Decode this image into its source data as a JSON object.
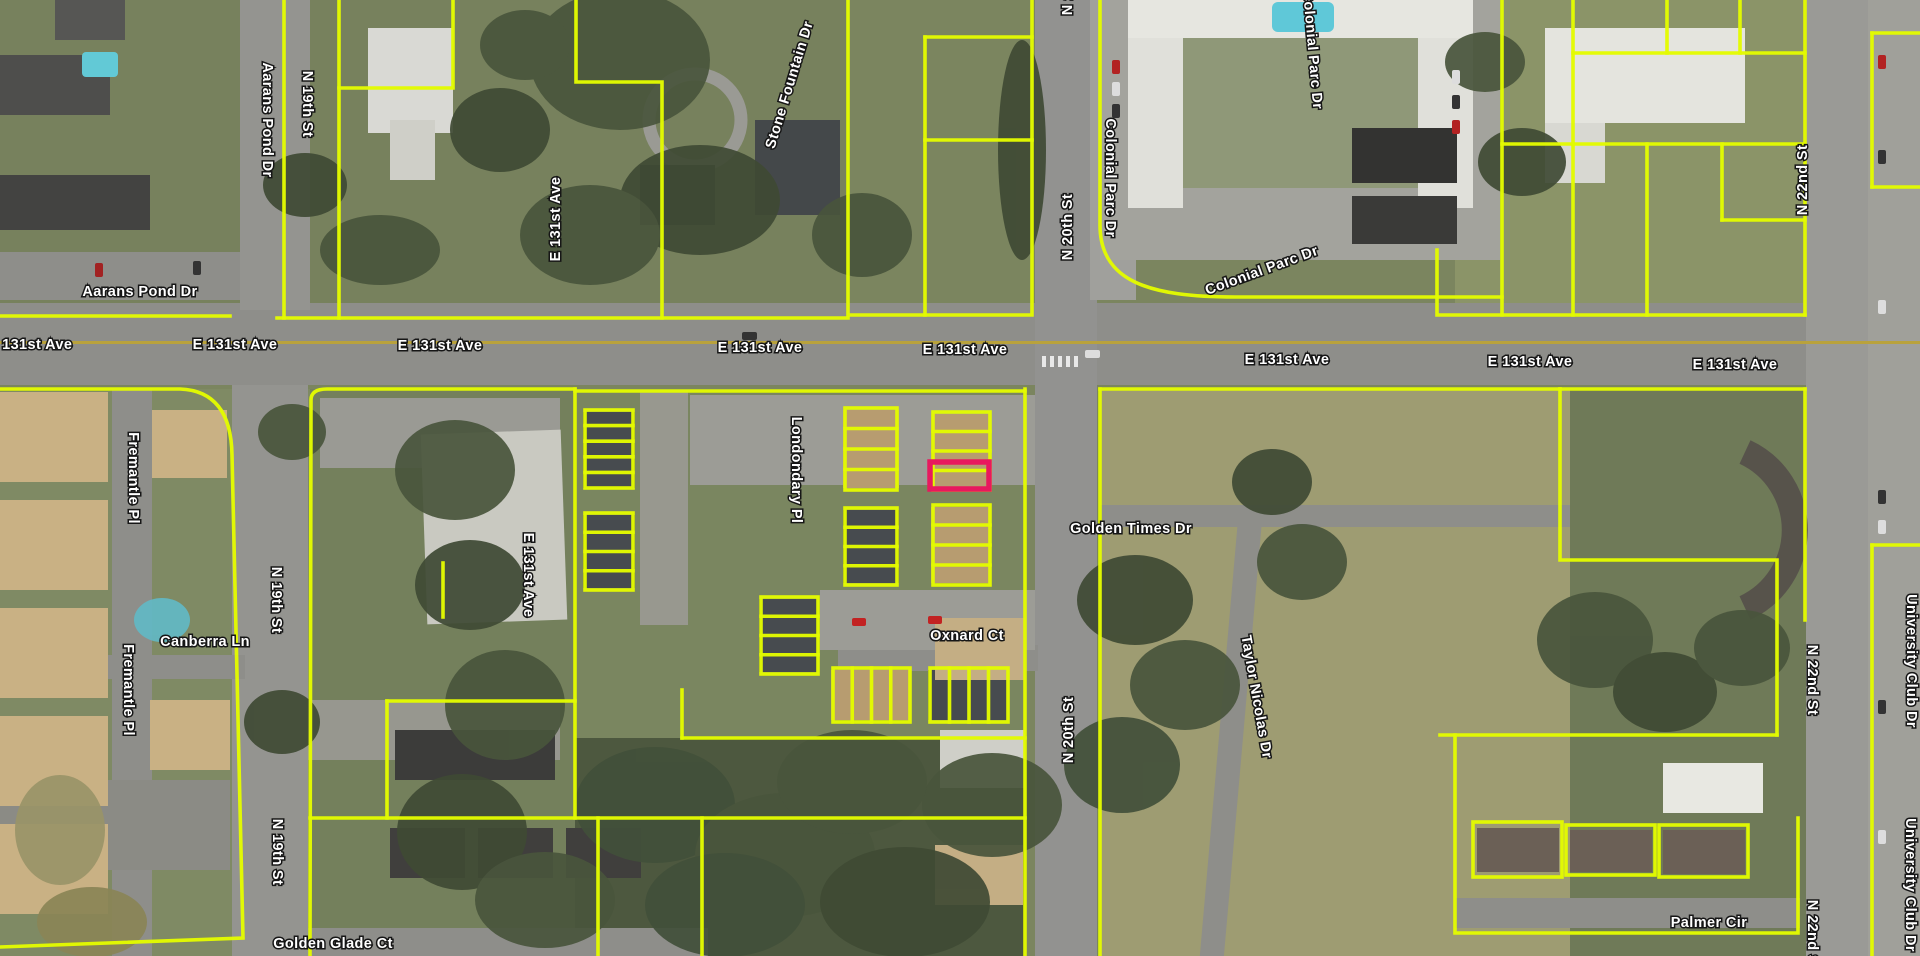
{
  "map": {
    "view_type": "aerial-parcel-map",
    "colors": {
      "parcel_outline": "#e3fb00",
      "selected_parcel": "#e8185e",
      "label_fill": "#ffffff",
      "label_halo": "#161616",
      "road": "#8e8e8a",
      "centerline": "#b9a23c"
    },
    "selected_parcel": {
      "x": 930,
      "y": 462,
      "width": 59,
      "height": 27
    },
    "street_labels": [
      {
        "text": "Aarans Pond Dr",
        "x": 267,
        "y": 120,
        "rot": 90
      },
      {
        "text": "N 19th St",
        "x": 307,
        "y": 104,
        "rot": 90
      },
      {
        "text": "Aarans Pond Dr",
        "x": 140,
        "y": 292,
        "rot": 0
      },
      {
        "text": "E 131st Ave",
        "x": 30,
        "y": 345,
        "rot": 0
      },
      {
        "text": "E 131st Ave",
        "x": 235,
        "y": 345,
        "rot": 0
      },
      {
        "text": "E 131st Ave",
        "x": 440,
        "y": 346,
        "rot": 0
      },
      {
        "text": "E 131st Ave",
        "x": 760,
        "y": 348,
        "rot": 0
      },
      {
        "text": "E 131st Ave",
        "x": 965,
        "y": 350,
        "rot": 0
      },
      {
        "text": "E 131st Ave",
        "x": 1287,
        "y": 360,
        "rot": 0
      },
      {
        "text": "E 131st Ave",
        "x": 1530,
        "y": 362,
        "rot": 0
      },
      {
        "text": "E 131st Ave",
        "x": 1735,
        "y": 365,
        "rot": 0
      },
      {
        "text": "E 131st Ave",
        "x": 556,
        "y": 219,
        "rot": -90
      },
      {
        "text": "E 131st Ave",
        "x": 528,
        "y": 575,
        "rot": 90
      },
      {
        "text": "Stone Fountain Dr",
        "x": 790,
        "y": 85,
        "rot": -73
      },
      {
        "text": "N 20th St",
        "x": 1068,
        "y": -18,
        "rot": -90
      },
      {
        "text": "N 20th St",
        "x": 1068,
        "y": 227,
        "rot": -90
      },
      {
        "text": "N 20th St",
        "x": 1069,
        "y": 730,
        "rot": -90
      },
      {
        "text": "Colonial Parc Dr",
        "x": 1110,
        "y": 178,
        "rot": 90
      },
      {
        "text": "Colonial Parc Dr",
        "x": 1312,
        "y": 50,
        "rot": 85
      },
      {
        "text": "Colonial Parc Dr",
        "x": 1262,
        "y": 271,
        "rot": -20
      },
      {
        "text": "N 22nd St",
        "x": 1803,
        "y": 180,
        "rot": -90
      },
      {
        "text": "N 22nd St",
        "x": 1812,
        "y": 680,
        "rot": 90
      },
      {
        "text": "N 22nd St",
        "x": 1812,
        "y": 935,
        "rot": 90
      },
      {
        "text": "University Club Dr",
        "x": 1911,
        "y": 661,
        "rot": 90
      },
      {
        "text": "University Club Dr",
        "x": 1910,
        "y": 885,
        "rot": 90
      },
      {
        "text": "Londondary Pl",
        "x": 796,
        "y": 470,
        "rot": 90
      },
      {
        "text": "Fremantle Pl",
        "x": 133,
        "y": 478,
        "rot": 90
      },
      {
        "text": "Fremantle Pl",
        "x": 128,
        "y": 690,
        "rot": 90
      },
      {
        "text": "N 19th St",
        "x": 276,
        "y": 600,
        "rot": 90
      },
      {
        "text": "N 19th St",
        "x": 277,
        "y": 852,
        "rot": 90
      },
      {
        "text": "Canberra Ln",
        "x": 205,
        "y": 642,
        "rot": 0
      },
      {
        "text": "Golden Times Dr",
        "x": 1131,
        "y": 529,
        "rot": 0
      },
      {
        "text": "Oxnard Ct",
        "x": 967,
        "y": 636,
        "rot": 0
      },
      {
        "text": "Taylor Nicolas Dr",
        "x": 1256,
        "y": 697,
        "rot": 80
      },
      {
        "text": "Golden Glade Ct",
        "x": 333,
        "y": 944,
        "rot": 0
      },
      {
        "text": "Palmer Cir",
        "x": 1709,
        "y": 923,
        "rot": 0
      }
    ],
    "parcel_paths": [
      "M0,316 H230",
      "M284,0 V318",
      "M277,318 H848",
      "M339,0 V318",
      "M339,88 H453 V0",
      "M576,0 V82 H662 V318",
      "M848,0 V315 H1032 V0",
      "M925,37 H1032",
      "M925,37 V315",
      "M925,140 H1032",
      "M1100,0 V225 C1100,282 1150,297 1235,297 L1502,297",
      "M1502,0 V315",
      "M1502,144 H1573",
      "M1437,250 V315 H1805",
      "M1573,0 V315",
      "M1805,0 V315",
      "M1573,53 H1805",
      "M1573,144 H1805",
      "M1667,0 V53",
      "M1740,0 V53",
      "M1647,144 V315",
      "M1722,144 V220",
      "M1722,220 H1805",
      "M1872,33 H1920",
      "M1872,33 V187",
      "M1872,187 H1920",
      "M0,389 H180 Q231,391 232,455 L243,938 L0,947",
      "M310,956 L311,400 Q311,389 327,389 H575",
      "M575,389 V818",
      "M575,391 H1025",
      "M1025,389 V956",
      "M310,818 H1025",
      "M387,701 H575",
      "M387,701 V818",
      "M682,690 V738",
      "M682,738 H1025",
      "M598,818 V956",
      "M702,818 V956",
      "M1100,389 V956",
      "M1100,389 H1560",
      "M1560,389 V560 H1777 V735",
      "M1560,389 H1805",
      "M1440,735 H1777",
      "M1455,735 V933 H1798 V818",
      "M1805,389 V620",
      "M1872,545 H1920",
      "M1872,545 V956",
      "M443,563 V617"
    ],
    "parcel_clusters": [
      {
        "x": 585,
        "y": 410,
        "w": 48,
        "h": 78,
        "rows": 5,
        "cols": 1
      },
      {
        "x": 845,
        "y": 408,
        "w": 52,
        "h": 82,
        "rows": 4,
        "cols": 1
      },
      {
        "x": 933,
        "y": 412,
        "w": 57,
        "h": 78,
        "rows": 4,
        "cols": 1
      },
      {
        "x": 585,
        "y": 513,
        "w": 48,
        "h": 77,
        "rows": 4,
        "cols": 1
      },
      {
        "x": 845,
        "y": 508,
        "w": 52,
        "h": 77,
        "rows": 4,
        "cols": 1
      },
      {
        "x": 933,
        "y": 505,
        "w": 57,
        "h": 80,
        "rows": 4,
        "cols": 1
      },
      {
        "x": 761,
        "y": 597,
        "w": 57,
        "h": 77,
        "rows": 4,
        "cols": 1
      },
      {
        "x": 833,
        "y": 668,
        "w": 77,
        "h": 54,
        "rows": 1,
        "cols": 4
      },
      {
        "x": 930,
        "y": 668,
        "w": 78,
        "h": 54,
        "rows": 1,
        "cols": 4
      },
      {
        "x": 1473,
        "y": 822,
        "w": 89,
        "h": 55,
        "rows": 1,
        "cols": 1
      },
      {
        "x": 1566,
        "y": 825,
        "w": 89,
        "h": 50,
        "rows": 1,
        "cols": 1
      },
      {
        "x": 1659,
        "y": 825,
        "w": 89,
        "h": 52,
        "rows": 1,
        "cols": 1
      }
    ]
  }
}
